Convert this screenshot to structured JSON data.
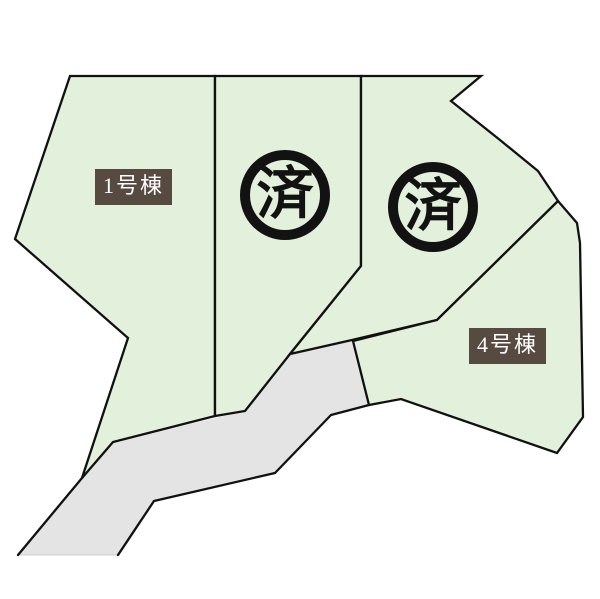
{
  "plan": {
    "canvas": {
      "width": 600,
      "height": 599
    },
    "palette": {
      "background": "#ffffff",
      "plot_fill": "#e3f0dc",
      "road_fill": "#e4e4e4",
      "outline": "#111111",
      "soft_edge": "#cccccc",
      "label_bg": "#564a41",
      "label_text": "#ffffff",
      "stamp_ink": "#121212"
    },
    "road": {
      "name": "road",
      "points": [
        [
          82,
          478
        ],
        [
          113,
          442
        ],
        [
          245,
          411
        ],
        [
          290,
          354
        ],
        [
          352,
          340
        ],
        [
          369,
          405
        ],
        [
          331,
          415
        ],
        [
          275,
          473
        ],
        [
          154,
          501
        ],
        [
          118,
          555
        ],
        [
          18,
          555
        ]
      ],
      "stroked_edges": [
        [
          [
            18,
            555
          ],
          [
            82,
            478
          ]
        ],
        [
          [
            369,
            405
          ],
          [
            331,
            415
          ],
          [
            275,
            473
          ],
          [
            154,
            501
          ],
          [
            118,
            555
          ]
        ]
      ],
      "soft_edge": [
        [
          18,
          555
        ],
        [
          118,
          555
        ]
      ]
    },
    "plots": [
      {
        "name": "plot-1",
        "points": [
          [
            70,
            76
          ],
          [
            215,
            76
          ],
          [
            215,
            416
          ],
          [
            113,
            442
          ],
          [
            82,
            478
          ],
          [
            128,
            338
          ],
          [
            15,
            239
          ]
        ]
      },
      {
        "name": "plot-2",
        "points": [
          [
            215,
            76
          ],
          [
            361,
            76
          ],
          [
            361,
            266
          ],
          [
            290,
            354
          ],
          [
            245,
            411
          ],
          [
            215,
            416
          ]
        ]
      },
      {
        "name": "plot-3",
        "points": [
          [
            361,
            76
          ],
          [
            481,
            76
          ],
          [
            451,
            101
          ],
          [
            500,
            140
          ],
          [
            538,
            171
          ],
          [
            558,
            201
          ],
          [
            437,
            320
          ],
          [
            352,
            340
          ],
          [
            290,
            354
          ],
          [
            361,
            266
          ]
        ]
      },
      {
        "name": "plot-4",
        "points": [
          [
            558,
            201
          ],
          [
            577,
            223
          ],
          [
            580,
            243
          ],
          [
            583,
            417
          ],
          [
            557,
            453
          ],
          [
            401,
            399
          ],
          [
            369,
            405
          ],
          [
            353,
            341
          ],
          [
            437,
            320
          ]
        ]
      }
    ],
    "labels": [
      {
        "text": "1号棟",
        "x": 95,
        "y": 169,
        "w": 77,
        "h": 36
      },
      {
        "text": "4号棟",
        "x": 469,
        "y": 328,
        "w": 77,
        "h": 36
      }
    ],
    "stamps": [
      {
        "text": "済",
        "x": 240,
        "y": 150,
        "size": 90,
        "ring": 10
      },
      {
        "text": "済",
        "x": 388,
        "y": 162,
        "size": 90,
        "ring": 10
      }
    ]
  }
}
